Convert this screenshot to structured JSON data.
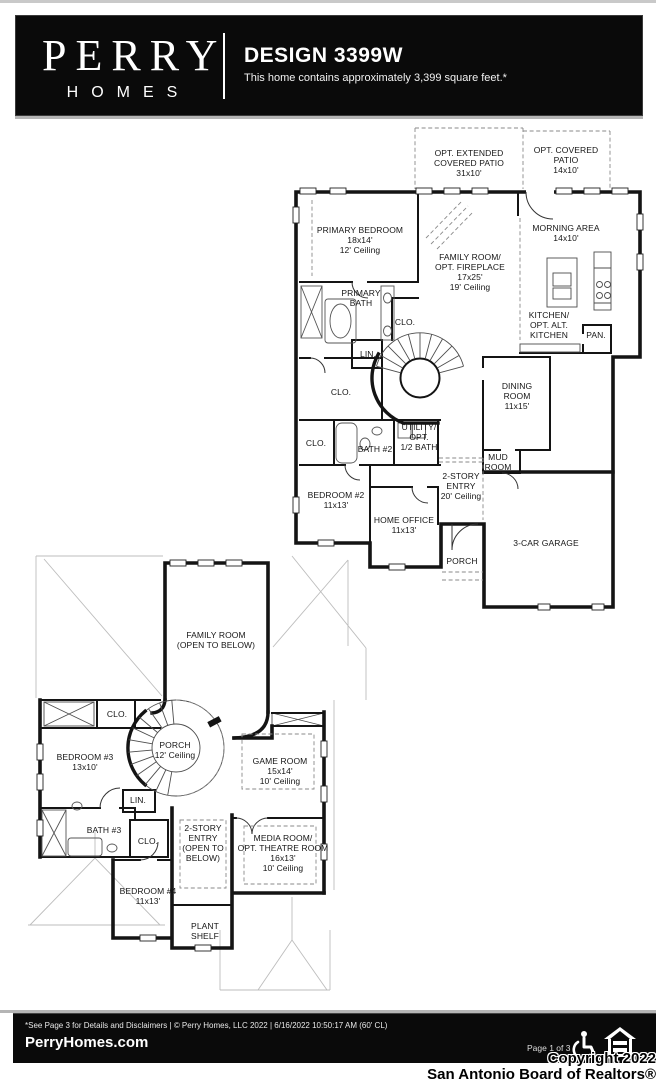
{
  "header": {
    "brand_line1": "PERRY",
    "brand_line2": "HOMES",
    "title": "DESIGN 3399W",
    "subtitle": "This home contains approximately 3,399 square feet.*"
  },
  "plans": {
    "first_floor": {
      "labels": [
        {
          "id": "opt-extended-covered-patio",
          "text": "OPT. EXTENDED\nCOVERED PATIO\n31x10'"
        },
        {
          "id": "opt-covered-patio",
          "text": "OPT. COVERED PATIO\n14x10'"
        },
        {
          "id": "primary-bedroom",
          "text": "PRIMARY BEDROOM\n18x14'\n12' Ceiling"
        },
        {
          "id": "family-room",
          "text": "FAMILY ROOM/\nOPT. FIREPLACE\n17x25'\n19' Ceiling"
        },
        {
          "id": "morning-area",
          "text": "MORNING AREA\n14x10'"
        },
        {
          "id": "primary-bath",
          "text": "PRIMARY\nBATH"
        },
        {
          "id": "closet-1",
          "text": "CLO."
        },
        {
          "id": "kitchen",
          "text": "KITCHEN/\nOPT. ALT.\nKITCHEN"
        },
        {
          "id": "pantry",
          "text": "PAN."
        },
        {
          "id": "linen-1",
          "text": "LIN."
        },
        {
          "id": "closet-2",
          "text": "CLO."
        },
        {
          "id": "dining-room",
          "text": "DINING\nROOM\n11x15'"
        },
        {
          "id": "closet-3",
          "text": "CLO."
        },
        {
          "id": "bath-2",
          "text": "BATH #2"
        },
        {
          "id": "utility",
          "text": "UTILITY/\nOPT.\n1/2 BATH"
        },
        {
          "id": "mud-room",
          "text": "MUD\nROOM"
        },
        {
          "id": "two-story-entry",
          "text": "2-STORY\nENTRY\n20' Ceiling"
        },
        {
          "id": "bedroom-2",
          "text": "BEDROOM #2\n11x13'"
        },
        {
          "id": "home-office",
          "text": "HOME OFFICE\n11x13'"
        },
        {
          "id": "porch",
          "text": "PORCH"
        },
        {
          "id": "garage",
          "text": "3-CAR GARAGE"
        }
      ]
    },
    "second_floor": {
      "labels": [
        {
          "id": "family-room-open",
          "text": "FAMILY ROOM\n(OPEN TO BELOW)"
        },
        {
          "id": "closet-4",
          "text": "CLO."
        },
        {
          "id": "porch-upper",
          "text": "PORCH\n12' Ceiling"
        },
        {
          "id": "bedroom-3",
          "text": "BEDROOM #3\n13x10'"
        },
        {
          "id": "game-room",
          "text": "GAME ROOM\n15x14'\n10' Ceiling"
        },
        {
          "id": "linen-2",
          "text": "LIN."
        },
        {
          "id": "bath-3",
          "text": "BATH #3"
        },
        {
          "id": "closet-5",
          "text": "CLO."
        },
        {
          "id": "two-story-entry-open",
          "text": "2-STORY\nENTRY\n(OPEN TO\nBELOW)"
        },
        {
          "id": "media-room",
          "text": "MEDIA ROOM/\nOPT. THEATRE ROOM\n16x13'\n10' Ceiling"
        },
        {
          "id": "bedroom-4",
          "text": "BEDROOM #4\n11x13'"
        },
        {
          "id": "plant-shelf",
          "text": "PLANT\nSHELF"
        }
      ]
    }
  },
  "footer": {
    "disclaimer": "*See Page 3 for Details and Disclaimers  |  © Perry Homes, LLC 2022  |  6/16/2022 10:50:17 AM (60' CL)",
    "website": "PerryHomes.com",
    "page_label": "Page 1 of 3",
    "copyright_line1": "Copyright 2022",
    "copyright_line2": "San Antonio Board of Realtors®"
  },
  "colors": {
    "bar_background": "#0a0a0a",
    "wall": "#141414",
    "roof_line": "#bdbdbd",
    "dashed_optional": "#8a8a8a"
  }
}
